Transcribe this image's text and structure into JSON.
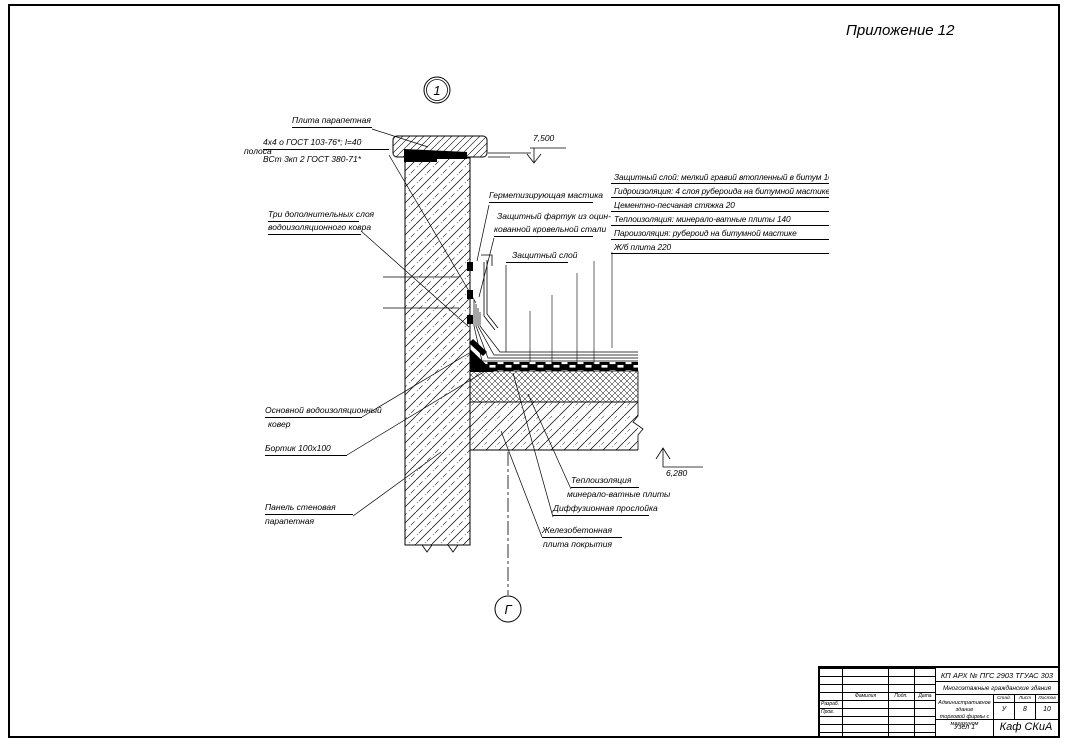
{
  "sheet": {
    "appendix": "Приложение 12",
    "node_marker": "1",
    "axis_marker": "Г"
  },
  "elevations": {
    "parapet_top": "7,500",
    "roof_top": "6,280"
  },
  "callouts": {
    "parapet_slab": "Плита парапетная",
    "strip_prefix": "полоса",
    "strip_spec_num": "4х4 о ГОСТ 103-76*; l=40",
    "strip_spec_den": "ВСт 3кп 2 ГОСТ 380-71*",
    "extra_layers_1": "Три дополнительных слоя",
    "extra_layers_2": "водоизоляционного ковра",
    "sealing_mastic": "Герметизирующая мастика",
    "apron_1": "Защитный фартук из оцин-",
    "apron_2": "кованной кровельной стали",
    "protective_layer": "Защитный слой",
    "main_carpet_1": "Основной водоизоляционный",
    "main_carpet_2": "ковер",
    "curb": "Бортик 100х100",
    "wall_panel_1": "Панель стеновая",
    "wall_panel_2": "парапетная",
    "insulation_1": "Теплоизоляция",
    "insulation_2": "минерало-ватные плиты",
    "diffusion": "Диффузионная прослойка",
    "rc_slab_1": "Железобетонная",
    "rc_slab_2": "плита покрытия"
  },
  "layer_table": {
    "rows": [
      "Защитный слой: мелкий гравий втопленный в битум   10",
      "Гидроизоляция: 4 слоя рубероида на битумной мастике   8",
      "Цементно-песчаная стяжка   20",
      "Теплоизоляция: минерало-ватные плиты   140",
      "Пароизоляция: рубероид на битумной мастике",
      "Ж/б плита   220"
    ]
  },
  "title_block": {
    "doc_code": "КП АРХ № ПГС 2903 ТГУАС 303",
    "theme": "Многоэтажные гражданские здания",
    "object_1": "Административное здание",
    "object_2": "торговой фирмы с магазином",
    "stage_label": "Стад.",
    "sheet_label": "Лист",
    "sheets_label": "Листов",
    "stage": "У",
    "sheet": "8",
    "sheets": "10",
    "drawing_name": "Узел 1",
    "department": "Каф СКиА",
    "col_surname": "Фамилия",
    "col_signature": "Подп.",
    "col_date": "Дата",
    "row_developed": "Разраб.",
    "row_checked": "Пров."
  }
}
